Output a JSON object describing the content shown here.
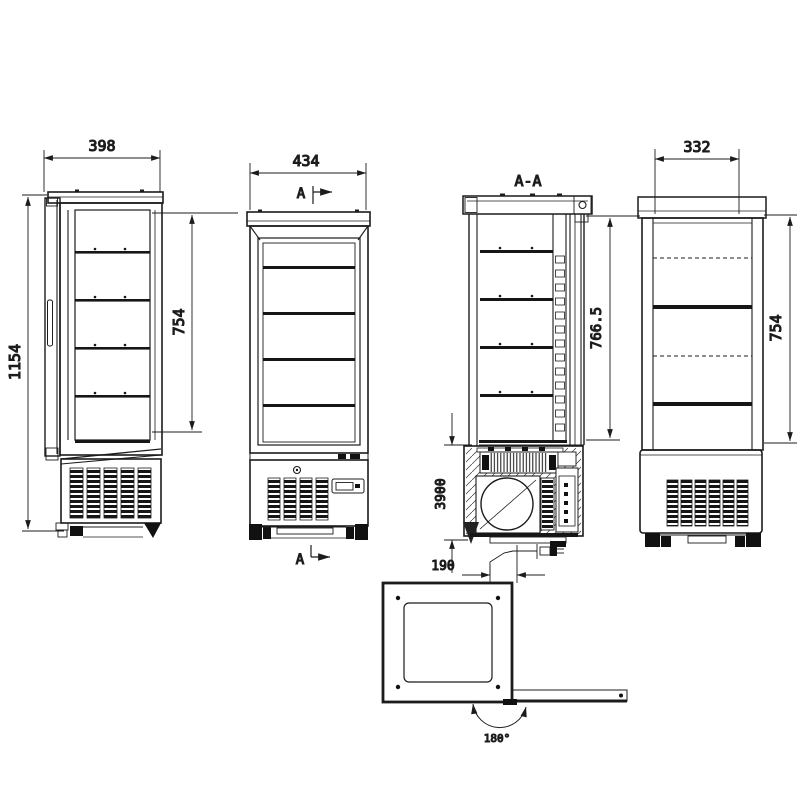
{
  "drawing": {
    "line_color": "#1c1c1c",
    "background": "#ffffff",
    "views": {
      "side": {
        "width_dim": "398",
        "overall_height_dim": "1154",
        "glass_height_dim": "754"
      },
      "front": {
        "width_dim": "434",
        "section_cut_label_top": "A",
        "section_cut_label_bottom": "A"
      },
      "section": {
        "title": "A-A",
        "interior_height_dim": "766.5",
        "machine_compartment_dim": "3900",
        "drain_offset_dim": "190"
      },
      "rear": {
        "width_dim": "332",
        "glass_height_dim": "754"
      },
      "plan": {
        "door_swing_dim": "180°"
      }
    }
  }
}
